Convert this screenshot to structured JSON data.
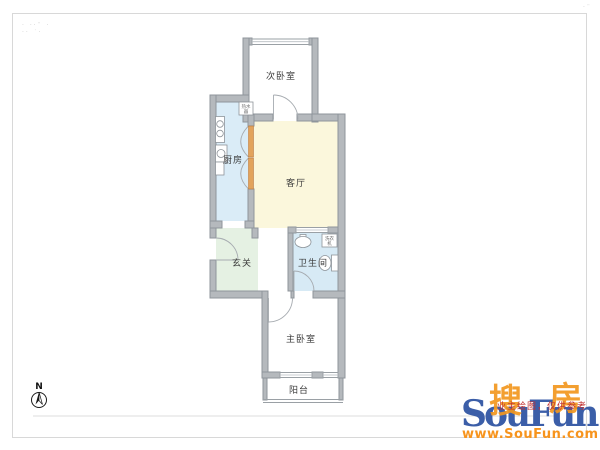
{
  "page": {
    "background": "#FFFFFF",
    "border_color": "#D8D8D8"
  },
  "watermark": {
    "top_left_line1": "· ··¨ ·",
    "top_left_line2": "·· ˙·",
    "top_right": "·¨"
  },
  "compass": {
    "label": "N"
  },
  "floorplan": {
    "wall_color": "#B5B9BD",
    "rooms": [
      {
        "id": "secondary-bedroom",
        "label": "次卧室",
        "fill": "#FFFFFF"
      },
      {
        "id": "kitchen",
        "label": "厨房",
        "fill": "#DAECF7"
      },
      {
        "id": "living-room",
        "label": "客厅",
        "fill": "#FBF7DC"
      },
      {
        "id": "foyer",
        "label": "玄关",
        "fill": "#E5F1E3"
      },
      {
        "id": "bathroom",
        "label": "卫生间",
        "fill": "#D7EAF5"
      },
      {
        "id": "master-bedroom",
        "label": "主卧室",
        "fill": "#FFFFFF"
      },
      {
        "id": "balcony",
        "label": "阳台",
        "fill": "#FFFFFF"
      }
    ],
    "fixtures": {
      "kitchen_box_line1": "热水",
      "kitchen_box_line2": "器",
      "bathroom_box_line1": "洗衣",
      "bathroom_box_line2": "机"
    }
  },
  "logo": {
    "cn_left": "搜",
    "cn_right": "房",
    "name": "SouFun",
    "disclaimer": "业主绘图，仅供参考",
    "url": "www.SouFun.com",
    "colors": {
      "orange": "#F2971F",
      "blue": "#3B5EA8",
      "red": "#C03030"
    }
  }
}
